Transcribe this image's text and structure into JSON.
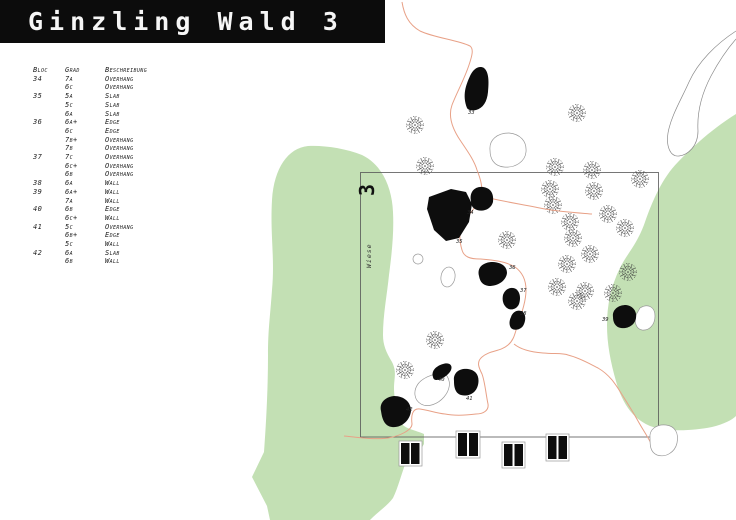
{
  "title": "Ginzling Wald 3",
  "table": {
    "headers": {
      "bloc": "Bloc",
      "grad": "Grad",
      "beschreibung": "Beschreibung"
    },
    "rows": [
      {
        "bloc": "34",
        "grad": "7a",
        "besch": "Overhang"
      },
      {
        "bloc": "",
        "grad": "6c",
        "besch": "Overhang"
      },
      {
        "bloc": "35",
        "grad": "5a",
        "besch": "Slab"
      },
      {
        "bloc": "",
        "grad": "5c",
        "besch": "Slab"
      },
      {
        "bloc": "",
        "grad": "6a",
        "besch": "Slab"
      },
      {
        "bloc": "36",
        "grad": "6a+",
        "besch": "Edge"
      },
      {
        "bloc": "",
        "grad": "6c",
        "besch": "Edge"
      },
      {
        "bloc": "",
        "grad": "7b+",
        "besch": "Overhang"
      },
      {
        "bloc": "",
        "grad": "7b",
        "besch": "Overhang"
      },
      {
        "bloc": "37",
        "grad": "7c",
        "besch": "Overhang"
      },
      {
        "bloc": "",
        "grad": "6c+",
        "besch": "Overhang"
      },
      {
        "bloc": "",
        "grad": "6b",
        "besch": "Overhang"
      },
      {
        "bloc": "38",
        "grad": "6a",
        "besch": "Wall"
      },
      {
        "bloc": "39",
        "grad": "6a+",
        "besch": "Wall"
      },
      {
        "bloc": "",
        "grad": "7a",
        "besch": "Wall"
      },
      {
        "bloc": "40",
        "grad": "6b",
        "besch": "Edge"
      },
      {
        "bloc": "",
        "grad": "6c+",
        "besch": "Wall"
      },
      {
        "bloc": "41",
        "grad": "5c",
        "besch": "Overhang"
      },
      {
        "bloc": "",
        "grad": "6b+",
        "besch": "Edge"
      },
      {
        "bloc": "",
        "grad": "5c",
        "besch": "Wall"
      },
      {
        "bloc": "42",
        "grad": "6a",
        "besch": "Slab"
      },
      {
        "bloc": "",
        "grad": "6b",
        "besch": "Wall"
      }
    ]
  },
  "map": {
    "area_label": "3",
    "meadow_label": "Wiese",
    "boulder_labels": [
      "33",
      "34",
      "35",
      "36",
      "37",
      "38",
      "39",
      "40",
      "41",
      "42"
    ],
    "colors": {
      "meadow_green": "#c3e0b4",
      "trail_orange": "#e8a187",
      "boulder_black": "#0d0d0d",
      "title_bg": "#0c0c0c",
      "title_text": "#f6f6f6"
    }
  }
}
